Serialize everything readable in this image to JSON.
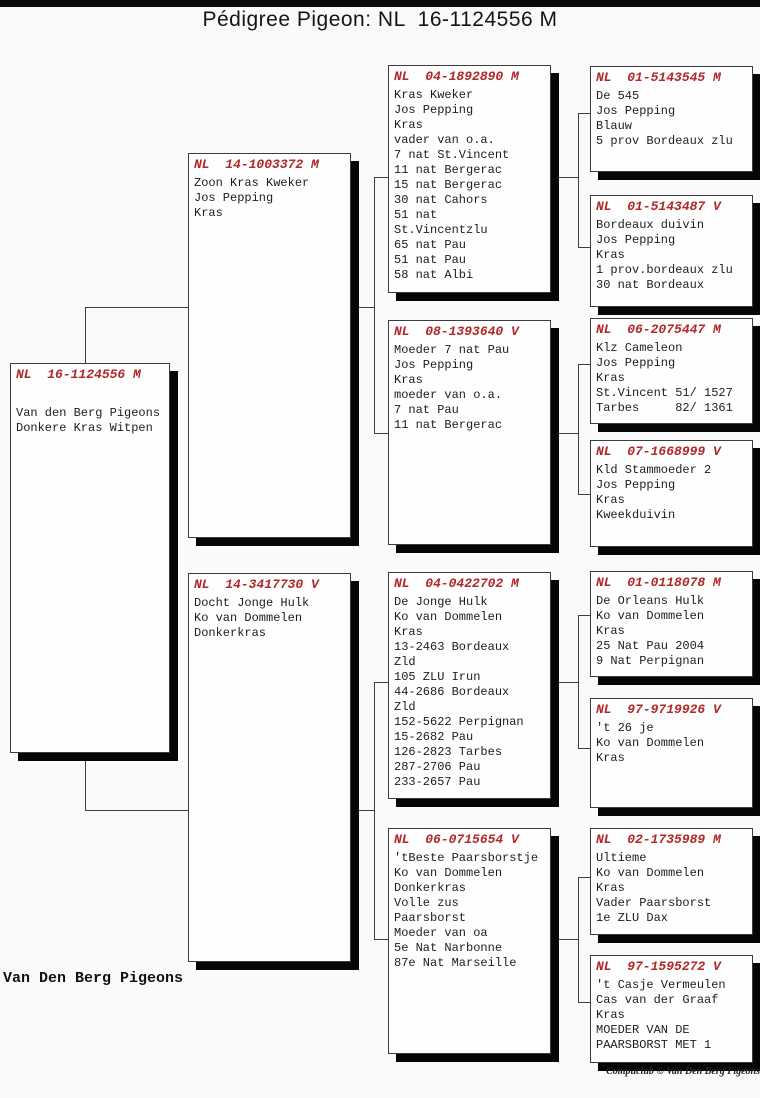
{
  "title": "Pédigree Pigeon: NL  16-1124556 M",
  "footer": {
    "loft_name": "Van Den Berg Pigeons",
    "credit": "Compuclub © Van Den Berg Pigeons"
  },
  "colors": {
    "header_red": "#b02828",
    "shadow": "#060606",
    "connector": "#3f3f3f",
    "box_background": "#fefefe"
  },
  "nodes": [
    {
      "id": "subject",
      "generation": 1,
      "header": "NL  16-1124556 M",
      "lines": [
        "Van den Berg Pigeons",
        "Donkere Kras Witpen"
      ]
    },
    {
      "id": "sire",
      "generation": 2,
      "header": "NL  14-1003372 M",
      "lines": [
        "Zoon Kras Kweker",
        "Jos Pepping",
        "Kras"
      ]
    },
    {
      "id": "dam",
      "generation": 2,
      "header": "NL  14-3417730 V",
      "lines": [
        "Docht Jonge Hulk",
        "Ko van Dommelen",
        "Donkerkras"
      ]
    },
    {
      "id": "sire-sire",
      "generation": 3,
      "header": "NL  04-1892890 M",
      "lines": [
        "Kras Kweker",
        "Jos Pepping",
        "Kras",
        "vader van o.a.",
        "7 nat St.Vincent",
        "11 nat Bergerac",
        "15 nat Bergerac",
        "30 nat Cahors",
        "51 nat",
        "St.Vincentzlu",
        "65 nat Pau",
        "51 nat Pau",
        "58 nat Albi"
      ]
    },
    {
      "id": "sire-dam",
      "generation": 3,
      "header": "NL  08-1393640 V",
      "lines": [
        "Moeder 7 nat Pau",
        "Jos Pepping",
        "Kras",
        "moeder van o.a.",
        "7 nat Pau",
        "11 nat Bergerac"
      ]
    },
    {
      "id": "dam-sire",
      "generation": 3,
      "header": "NL  04-0422702 M",
      "lines": [
        "De Jonge Hulk",
        "Ko van Dommelen",
        "Kras",
        "13-2463 Bordeaux",
        "Zld",
        "105 ZLU Irun",
        "44-2686 Bordeaux",
        "Zld",
        "152-5622 Perpignan",
        "15-2682 Pau",
        "126-2823 Tarbes",
        "287-2706 Pau",
        "233-2657 Pau"
      ]
    },
    {
      "id": "dam-dam",
      "generation": 3,
      "header": "NL  06-0715654 V",
      "lines": [
        "'tBeste Paarsborstje",
        "Ko van Dommelen",
        "Donkerkras",
        "Volle zus",
        "Paarsborst",
        "Moeder van oa",
        "5e Nat Narbonne",
        "87e Nat Marseille"
      ]
    },
    {
      "id": "sire-sire-sire",
      "generation": 4,
      "header": "NL  01-5143545 M",
      "lines": [
        "De 545",
        "Jos Pepping",
        "Blauw",
        "5 prov Bordeaux zlu"
      ]
    },
    {
      "id": "sire-sire-dam",
      "generation": 4,
      "header": "NL  01-5143487 V",
      "lines": [
        "Bordeaux duivin",
        "Jos Pepping",
        "Kras",
        "1 prov.bordeaux zlu",
        "30 nat Bordeaux"
      ]
    },
    {
      "id": "sire-dam-sire",
      "generation": 4,
      "header": "NL  06-2075447 M",
      "lines": [
        "Klz Cameleon",
        "Jos Pepping",
        "Kras",
        "St.Vincent 51/ 1527",
        "Tarbes     82/ 1361"
      ]
    },
    {
      "id": "sire-dam-dam",
      "generation": 4,
      "header": "NL  07-1668999 V",
      "lines": [
        "Kld Stammoeder 2",
        "Jos Pepping",
        "Kras",
        "Kweekduivin"
      ]
    },
    {
      "id": "dam-sire-sire",
      "generation": 4,
      "header": "NL  01-0118078 M",
      "lines": [
        "De Orleans Hulk",
        "Ko van Dommelen",
        "Kras",
        "25 Nat Pau 2004",
        "9 Nat Perpignan"
      ]
    },
    {
      "id": "dam-sire-dam",
      "generation": 4,
      "header": "NL  97-9719926 V",
      "lines": [
        "'t 26 je",
        "Ko van Dommelen",
        "Kras"
      ]
    },
    {
      "id": "dam-dam-sire",
      "generation": 4,
      "header": "NL  02-1735989 M",
      "lines": [
        "Ultieme",
        "Ko van Dommelen",
        "Kras",
        "Vader Paarsborst",
        "1e ZLU Dax"
      ]
    },
    {
      "id": "dam-dam-dam",
      "generation": 4,
      "header": "NL  97-1595272 V",
      "lines": [
        "'t Casje Vermeulen",
        "Cas van der Graaf",
        "Kras",
        "MOEDER VAN DE",
        "PAARSBORST MET 1"
      ]
    }
  ]
}
